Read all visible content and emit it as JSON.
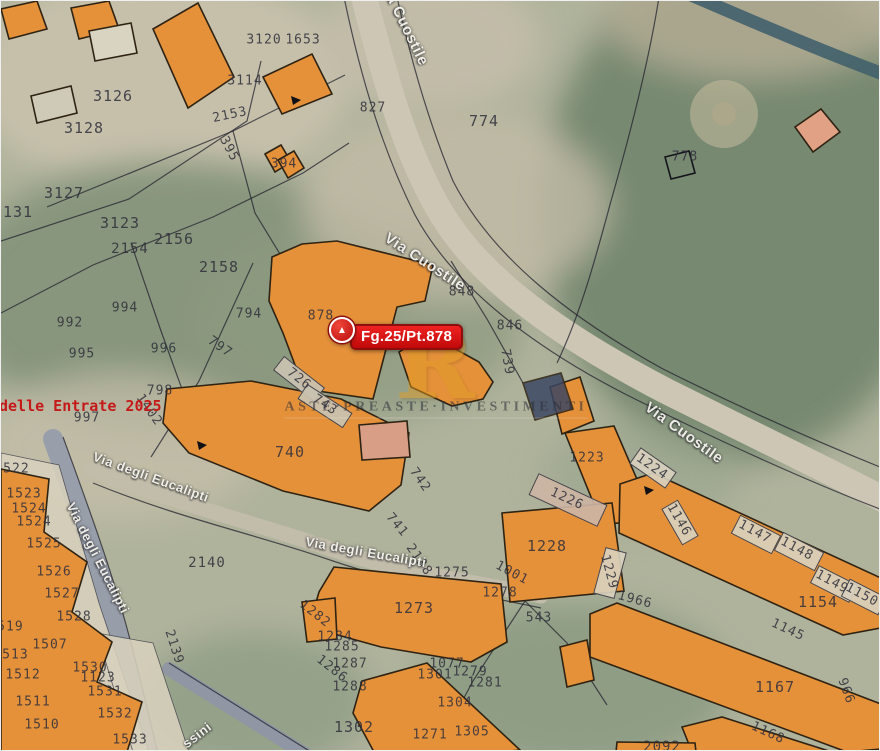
{
  "map": {
    "marker": {
      "label": "Fg.25/Pt.878"
    },
    "watermark": {
      "logo_letter": "R",
      "text": "ASTE·PREASTE·INVESTIMENTI"
    },
    "red_overlay_text": "delle Entrate 2025",
    "colors": {
      "building_fill": "#e5913a",
      "building_stroke": "#2e2313",
      "marker_red": "#d11010",
      "marker_border": "#8e0e0e",
      "watermark_gold": "#e09c25",
      "parcel_label_ink": "#2f2f3a",
      "street_text": "#f3f2ec",
      "red_text": "#c51a1a",
      "road_light": "#cdc6b5",
      "road_blue": "#979daa",
      "vegetation": "#75876f"
    },
    "street_labels": [
      {
        "text": "Via Cuostile",
        "x": 403,
        "y": 22,
        "r": 64,
        "s": 15
      },
      {
        "text": "Via Cuostile",
        "x": 424,
        "y": 261,
        "r": 33,
        "s": 15
      },
      {
        "text": "Via Cuostile",
        "x": 683,
        "y": 432,
        "r": 36,
        "s": 15
      },
      {
        "text": "Via degli Eucalipti",
        "x": 150,
        "y": 476,
        "r": 20,
        "s": 13
      },
      {
        "text": "Via degli Eucalipti",
        "x": 365,
        "y": 551,
        "r": 10,
        "s": 13
      },
      {
        "text": "Via degli Eucalipti",
        "x": 97,
        "y": 557,
        "r": 63,
        "s": 13
      },
      {
        "text": "ssini",
        "x": 196,
        "y": 734,
        "r": -38,
        "s": 13
      }
    ],
    "parcel_labels": [
      {
        "t": "3120",
        "x": 263,
        "y": 39
      },
      {
        "t": "1653",
        "x": 302,
        "y": 39
      },
      {
        "t": "3114",
        "x": 244,
        "y": 80
      },
      {
        "t": "827",
        "x": 372,
        "y": 107
      },
      {
        "t": "774",
        "x": 483,
        "y": 120,
        "s": 15
      },
      {
        "t": "778",
        "x": 684,
        "y": 156
      },
      {
        "t": "3126",
        "x": 112,
        "y": 95,
        "s": 15
      },
      {
        "t": "3128",
        "x": 83,
        "y": 127,
        "s": 15
      },
      {
        "t": "3127",
        "x": 63,
        "y": 192,
        "s": 15
      },
      {
        "t": "3131",
        "x": 12,
        "y": 211,
        "s": 15
      },
      {
        "t": "3123",
        "x": 119,
        "y": 222,
        "s": 15
      },
      {
        "t": "2153",
        "x": 229,
        "y": 114,
        "r": -12
      },
      {
        "t": "395",
        "x": 228,
        "y": 148,
        "r": 62
      },
      {
        "t": "394",
        "x": 283,
        "y": 163
      },
      {
        "t": "2154",
        "x": 129,
        "y": 248,
        "s": 14
      },
      {
        "t": "2156",
        "x": 173,
        "y": 238,
        "s": 15
      },
      {
        "t": "2158",
        "x": 218,
        "y": 266,
        "s": 15
      },
      {
        "t": "994",
        "x": 124,
        "y": 307
      },
      {
        "t": "992",
        "x": 69,
        "y": 322
      },
      {
        "t": "995",
        "x": 81,
        "y": 353
      },
      {
        "t": "996",
        "x": 163,
        "y": 348
      },
      {
        "t": "794",
        "x": 248,
        "y": 313
      },
      {
        "t": "797",
        "x": 219,
        "y": 346,
        "r": 35
      },
      {
        "t": "798",
        "x": 159,
        "y": 390
      },
      {
        "t": "997",
        "x": 86,
        "y": 417
      },
      {
        "t": "1402",
        "x": 148,
        "y": 409,
        "r": 55
      },
      {
        "t": "878",
        "x": 320,
        "y": 315
      },
      {
        "t": "848",
        "x": 461,
        "y": 291
      },
      {
        "t": "846",
        "x": 509,
        "y": 325
      },
      {
        "t": "739",
        "x": 506,
        "y": 361,
        "r": 80
      },
      {
        "t": "726",
        "x": 298,
        "y": 378,
        "r": 38
      },
      {
        "t": "743",
        "x": 324,
        "y": 404,
        "r": 33
      },
      {
        "t": "740",
        "x": 289,
        "y": 451,
        "s": 15
      },
      {
        "t": "742",
        "x": 419,
        "y": 479,
        "r": 55
      },
      {
        "t": "741",
        "x": 396,
        "y": 524,
        "r": 50
      },
      {
        "t": "2138",
        "x": 418,
        "y": 559,
        "r": 55
      },
      {
        "t": "2140",
        "x": 206,
        "y": 562,
        "s": 14
      },
      {
        "t": "1275",
        "x": 451,
        "y": 572
      },
      {
        "t": "1273",
        "x": 413,
        "y": 607,
        "s": 15
      },
      {
        "t": "1001",
        "x": 511,
        "y": 572,
        "r": 28
      },
      {
        "t": "1278",
        "x": 499,
        "y": 592
      },
      {
        "t": "543",
        "x": 538,
        "y": 617
      },
      {
        "t": "1223",
        "x": 586,
        "y": 457
      },
      {
        "t": "1224",
        "x": 651,
        "y": 466,
        "r": 35
      },
      {
        "t": "1226",
        "x": 566,
        "y": 498,
        "r": 25
      },
      {
        "t": "1228",
        "x": 546,
        "y": 545,
        "s": 15
      },
      {
        "t": "1229",
        "x": 608,
        "y": 571,
        "r": 75
      },
      {
        "t": "1966",
        "x": 634,
        "y": 599,
        "r": 15
      },
      {
        "t": "1146",
        "x": 678,
        "y": 519,
        "r": 60
      },
      {
        "t": "1147",
        "x": 754,
        "y": 531,
        "r": 28
      },
      {
        "t": "1148",
        "x": 796,
        "y": 548,
        "r": 28
      },
      {
        "t": "1149",
        "x": 831,
        "y": 581,
        "r": 28
      },
      {
        "t": "1150",
        "x": 861,
        "y": 594,
        "r": 28
      },
      {
        "t": "1154",
        "x": 817,
        "y": 601,
        "s": 15
      },
      {
        "t": "1145",
        "x": 787,
        "y": 629,
        "r": 25
      },
      {
        "t": "1167",
        "x": 774,
        "y": 686,
        "s": 15
      },
      {
        "t": "1168",
        "x": 767,
        "y": 732,
        "r": 25
      },
      {
        "t": "2092",
        "x": 661,
        "y": 746,
        "s": 14
      },
      {
        "t": "966",
        "x": 845,
        "y": 690,
        "r": 70
      },
      {
        "t": "1302",
        "x": 353,
        "y": 726,
        "s": 15
      },
      {
        "t": "1304",
        "x": 454,
        "y": 702
      },
      {
        "t": "1305",
        "x": 471,
        "y": 731
      },
      {
        "t": "1301",
        "x": 434,
        "y": 674
      },
      {
        "t": "1279",
        "x": 469,
        "y": 671
      },
      {
        "t": "1281",
        "x": 484,
        "y": 682
      },
      {
        "t": "1077",
        "x": 446,
        "y": 663
      },
      {
        "t": "1271",
        "x": 429,
        "y": 734
      },
      {
        "t": "1282",
        "x": 314,
        "y": 613,
        "r": 38
      },
      {
        "t": "1284",
        "x": 334,
        "y": 636
      },
      {
        "t": "1285",
        "x": 341,
        "y": 646
      },
      {
        "t": "1286",
        "x": 331,
        "y": 668,
        "r": 38
      },
      {
        "t": "1287",
        "x": 349,
        "y": 663
      },
      {
        "t": "1288",
        "x": 349,
        "y": 686
      },
      {
        "t": "1522",
        "x": 11,
        "y": 468
      },
      {
        "t": "1523",
        "x": 23,
        "y": 493
      },
      {
        "t": "1524",
        "x": 28,
        "y": 508
      },
      {
        "t": "1524",
        "x": 33,
        "y": 521
      },
      {
        "t": "1525",
        "x": 43,
        "y": 543
      },
      {
        "t": "1526",
        "x": 53,
        "y": 571
      },
      {
        "t": "1527",
        "x": 61,
        "y": 593
      },
      {
        "t": "1528",
        "x": 73,
        "y": 616
      },
      {
        "t": "1519",
        "x": 5,
        "y": 626
      },
      {
        "t": "1507",
        "x": 49,
        "y": 644
      },
      {
        "t": "1513",
        "x": 10,
        "y": 654
      },
      {
        "t": "1512",
        "x": 22,
        "y": 674
      },
      {
        "t": "1511",
        "x": 32,
        "y": 701
      },
      {
        "t": "1510",
        "x": 41,
        "y": 724
      },
      {
        "t": "1530",
        "x": 89,
        "y": 667
      },
      {
        "t": "1123",
        "x": 97,
        "y": 677
      },
      {
        "t": "1531",
        "x": 104,
        "y": 691
      },
      {
        "t": "1532",
        "x": 114,
        "y": 713
      },
      {
        "t": "1533",
        "x": 129,
        "y": 739
      },
      {
        "t": "2139",
        "x": 173,
        "y": 646,
        "r": 72
      }
    ],
    "vegetation": [
      {
        "x": -30,
        "y": -30,
        "w": 380,
        "h": 220,
        "c": "#c9c2ad",
        "op": 0.9
      },
      {
        "x": 320,
        "y": -30,
        "w": 220,
        "h": 140,
        "c": "#c5beab",
        "op": 0.85
      },
      {
        "x": 540,
        "y": -40,
        "w": 400,
        "h": 500,
        "c": "#75876f",
        "op": 0.95
      },
      {
        "x": 600,
        "y": -50,
        "w": 300,
        "h": 130,
        "c": "#b7ae96",
        "op": 0.8
      },
      {
        "x": -50,
        "y": 160,
        "w": 440,
        "h": 270,
        "c": "#84937a",
        "op": 0.9
      },
      {
        "x": 190,
        "y": 225,
        "w": 330,
        "h": 195,
        "c": "#8d9a80",
        "op": 0.75
      },
      {
        "x": 300,
        "y": 110,
        "w": 310,
        "h": 190,
        "c": "#c2bba6",
        "op": 0.8
      },
      {
        "x": -20,
        "y": 370,
        "w": 280,
        "h": 150,
        "c": "#c6bfaa",
        "op": 0.75
      },
      {
        "x": 540,
        "y": 420,
        "w": 200,
        "h": 110,
        "c": "#97a48c",
        "op": 0.6
      },
      {
        "x": 420,
        "y": 600,
        "w": 310,
        "h": 170,
        "c": "#8a9a82",
        "op": 0.85
      },
      {
        "x": 140,
        "y": 630,
        "w": 230,
        "h": 140,
        "c": "#8a9a82",
        "op": 0.7
      }
    ],
    "roads": [
      {
        "d": "M 362,-8 C 382,70 402,145 436,205 C 476,278 565,338 665,390 C 765,440 845,478 895,505",
        "w": 26,
        "color": "#cdc6b5"
      },
      {
        "d": "M 690,-6 C 755,22 820,50 890,76",
        "w": 13,
        "color": "#41606b",
        "op": 0.9
      },
      {
        "d": "M 52,438 C 76,505 98,565 114,622 C 128,672 140,718 150,758",
        "w": 20,
        "color": "#979daa",
        "op": 0.95
      },
      {
        "d": "M 90,468 C 180,505 255,522 330,548 C 400,572 460,578 540,595",
        "w": 15,
        "color": "#c2bcab"
      },
      {
        "d": "M 168,668 L 312,758",
        "w": 14,
        "color": "#8f96a4",
        "op": 0.95
      }
    ],
    "boundary_lines": [
      "M 658,-4 C 648,60 630,130 610,200 C 596,252 580,312 556,362",
      "M 343,-4 C 360,78 382,150 414,214 C 454,288 536,348 626,394 C 726,444 806,480 884,510",
      "M 396,-4 C 410,60 428,122 452,180 C 492,258 572,318 662,368 C 762,418 834,448 884,468",
      "M 46,206 L 232,130 L 312,90 L 344,74",
      "M 0,240 L 128,198 L 246,120 L 260,60",
      "M 0,312 L 92,264 L 212,216 L 302,172 L 348,142",
      "M 232,130 L 254,212 L 282,258",
      "M 130,242 L 160,330 L 186,402",
      "M 252,262 L 198,380 L 150,456",
      "M 450,260 L 486,318 L 522,382",
      "M 524,600 L 472,680 L 434,751",
      "M 524,600 L 566,642 L 606,704",
      "M 62,436 C 86,502 108,562 124,620 C 138,670 148,716 158,758",
      "M 92,482 C 180,518 258,534 332,560 C 402,584 462,590 540,607",
      "M 168,662 L 310,751"
    ],
    "strips": [
      {
        "points": "0,452 58,464 98,602 148,751 98,751 58,642 16,522 0,506",
        "fill": "#d8d1bd"
      },
      {
        "points": "96,632 152,642 188,751 132,751",
        "fill": "#d8d1bd"
      }
    ],
    "buildings": [
      {
        "points": "0,8 36,0 46,28 8,38"
      },
      {
        "points": "70,7 108,0 118,28 78,38"
      },
      {
        "points": "152,28 197,2 233,76 187,107"
      },
      {
        "points": "262,76 311,53 331,93 281,113"
      },
      {
        "points": "264,153 280,144 290,161 274,171"
      },
      {
        "points": "277,159 293,150 303,167 287,177"
      },
      {
        "points": "794,126 820,108 839,131 812,151",
        "fill": "#e0a184"
      },
      {
        "points": "88,30 130,22 136,52 94,60",
        "fill": "#d9d3c2"
      },
      {
        "points": "30,95 70,85 76,112 36,122",
        "fill": "#cfc9b8"
      },
      {
        "points": "271,256 301,243 336,240 432,264 424,300 396,306 372,398 303,388 282,332 268,300"
      },
      {
        "points": "398,351 423,336 449,345 478,361 492,381 482,398 451,405 410,386"
      },
      {
        "points": "549,386 579,376 593,420 561,433"
      },
      {
        "points": "522,382 560,372 572,408 534,419",
        "fill": "#3c4763",
        "op": 0.85
      },
      {
        "points": "166,388 250,380 340,398 408,432 400,484 368,510 282,490 188,452 162,422"
      },
      {
        "points": "358,424 406,420 409,456 361,459",
        "fill": "#d99f86"
      },
      {
        "points": "564,432 613,425 654,520 601,523"
      },
      {
        "points": "501,512 611,502 623,590 509,601"
      },
      {
        "points": "619,483 652,472 880,577 880,627 842,634 618,532"
      },
      {
        "points": "333,566 500,583 506,641 470,661 380,646 308,626 318,591"
      },
      {
        "points": "301,601 334,597 336,638 306,641"
      },
      {
        "points": "361,680 426,662 519,749 500,751 373,751 352,712"
      },
      {
        "points": "0,468 48,478 43,531 86,561 71,611 111,641 96,681 141,701 126,751 0,751"
      },
      {
        "points": "589,613 616,602 880,703 880,748 846,751 589,656"
      },
      {
        "points": "681,726 721,716 831,751 691,751"
      },
      {
        "points": "559,646 586,639 593,679 566,686"
      },
      {
        "points": "616,741 694,742 695,751 615,751"
      }
    ],
    "cells": [
      {
        "x": 651,
        "y": 466,
        "w": 42,
        "h": 18,
        "r": 35
      },
      {
        "x": 678,
        "y": 520,
        "w": 40,
        "h": 17,
        "r": 60
      },
      {
        "x": 754,
        "y": 532,
        "w": 44,
        "h": 19,
        "r": 27
      },
      {
        "x": 797,
        "y": 549,
        "w": 44,
        "h": 19,
        "r": 27
      },
      {
        "x": 832,
        "y": 582,
        "w": 42,
        "h": 18,
        "r": 27
      },
      {
        "x": 862,
        "y": 595,
        "w": 40,
        "h": 18,
        "r": 27
      },
      {
        "x": 566,
        "y": 498,
        "w": 74,
        "h": 22,
        "r": 25,
        "fill": "#cdb5a4"
      },
      {
        "x": 608,
        "y": 571,
        "w": 20,
        "h": 46,
        "r": 15
      },
      {
        "x": 297,
        "y": 377,
        "w": 50,
        "h": 16,
        "r": 38,
        "fill": "#cac3b2"
      },
      {
        "x": 323,
        "y": 404,
        "w": 52,
        "h": 16,
        "r": 33,
        "fill": "#cac3b2"
      }
    ],
    "extras": {
      "parcel_square": "664,156 688,150 694,172 670,178",
      "mound": {
        "cx": 723,
        "cy": 113,
        "r": 34
      },
      "pointer_marks": [
        "290,95 300,99 292,104",
        "196,440 206,444 198,449",
        "643,485 653,489 645,494"
      ]
    }
  }
}
